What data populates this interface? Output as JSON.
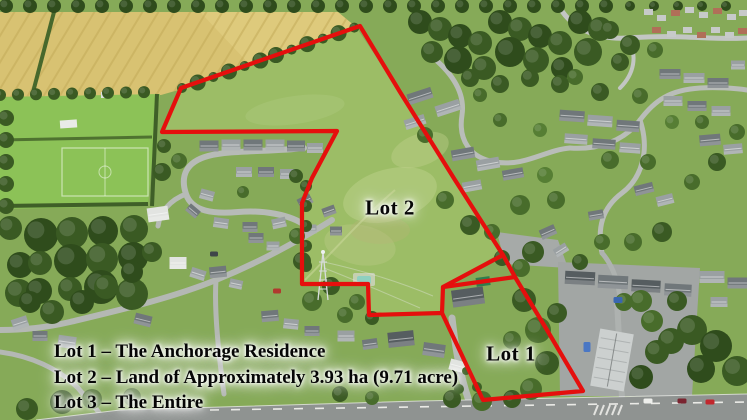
{
  "labels": {
    "lot2": "Lot 2",
    "lot1": "Lot 1"
  },
  "legend": {
    "lines": [
      "Lot 1 – The Anchorage Residence",
      "Lot 2 – Land of Approximately 3.93 ha (9.71 acre)",
      "Lot 3 – The Entire"
    ],
    "text_color": "#000000",
    "halo_color": "#ffffff"
  },
  "boundary": {
    "color": "#e50f0d",
    "outer_points": "360,26 400,92 455,180 503,255 515,277 547,330 583,391 483,400 442,313 369,315 368,284 302,284 302,203 312,178 337,131 162,132 181,88",
    "divider_a_points": "503,255 443,287 442,313",
    "divider_b_points": "443,287 515,277"
  }
}
